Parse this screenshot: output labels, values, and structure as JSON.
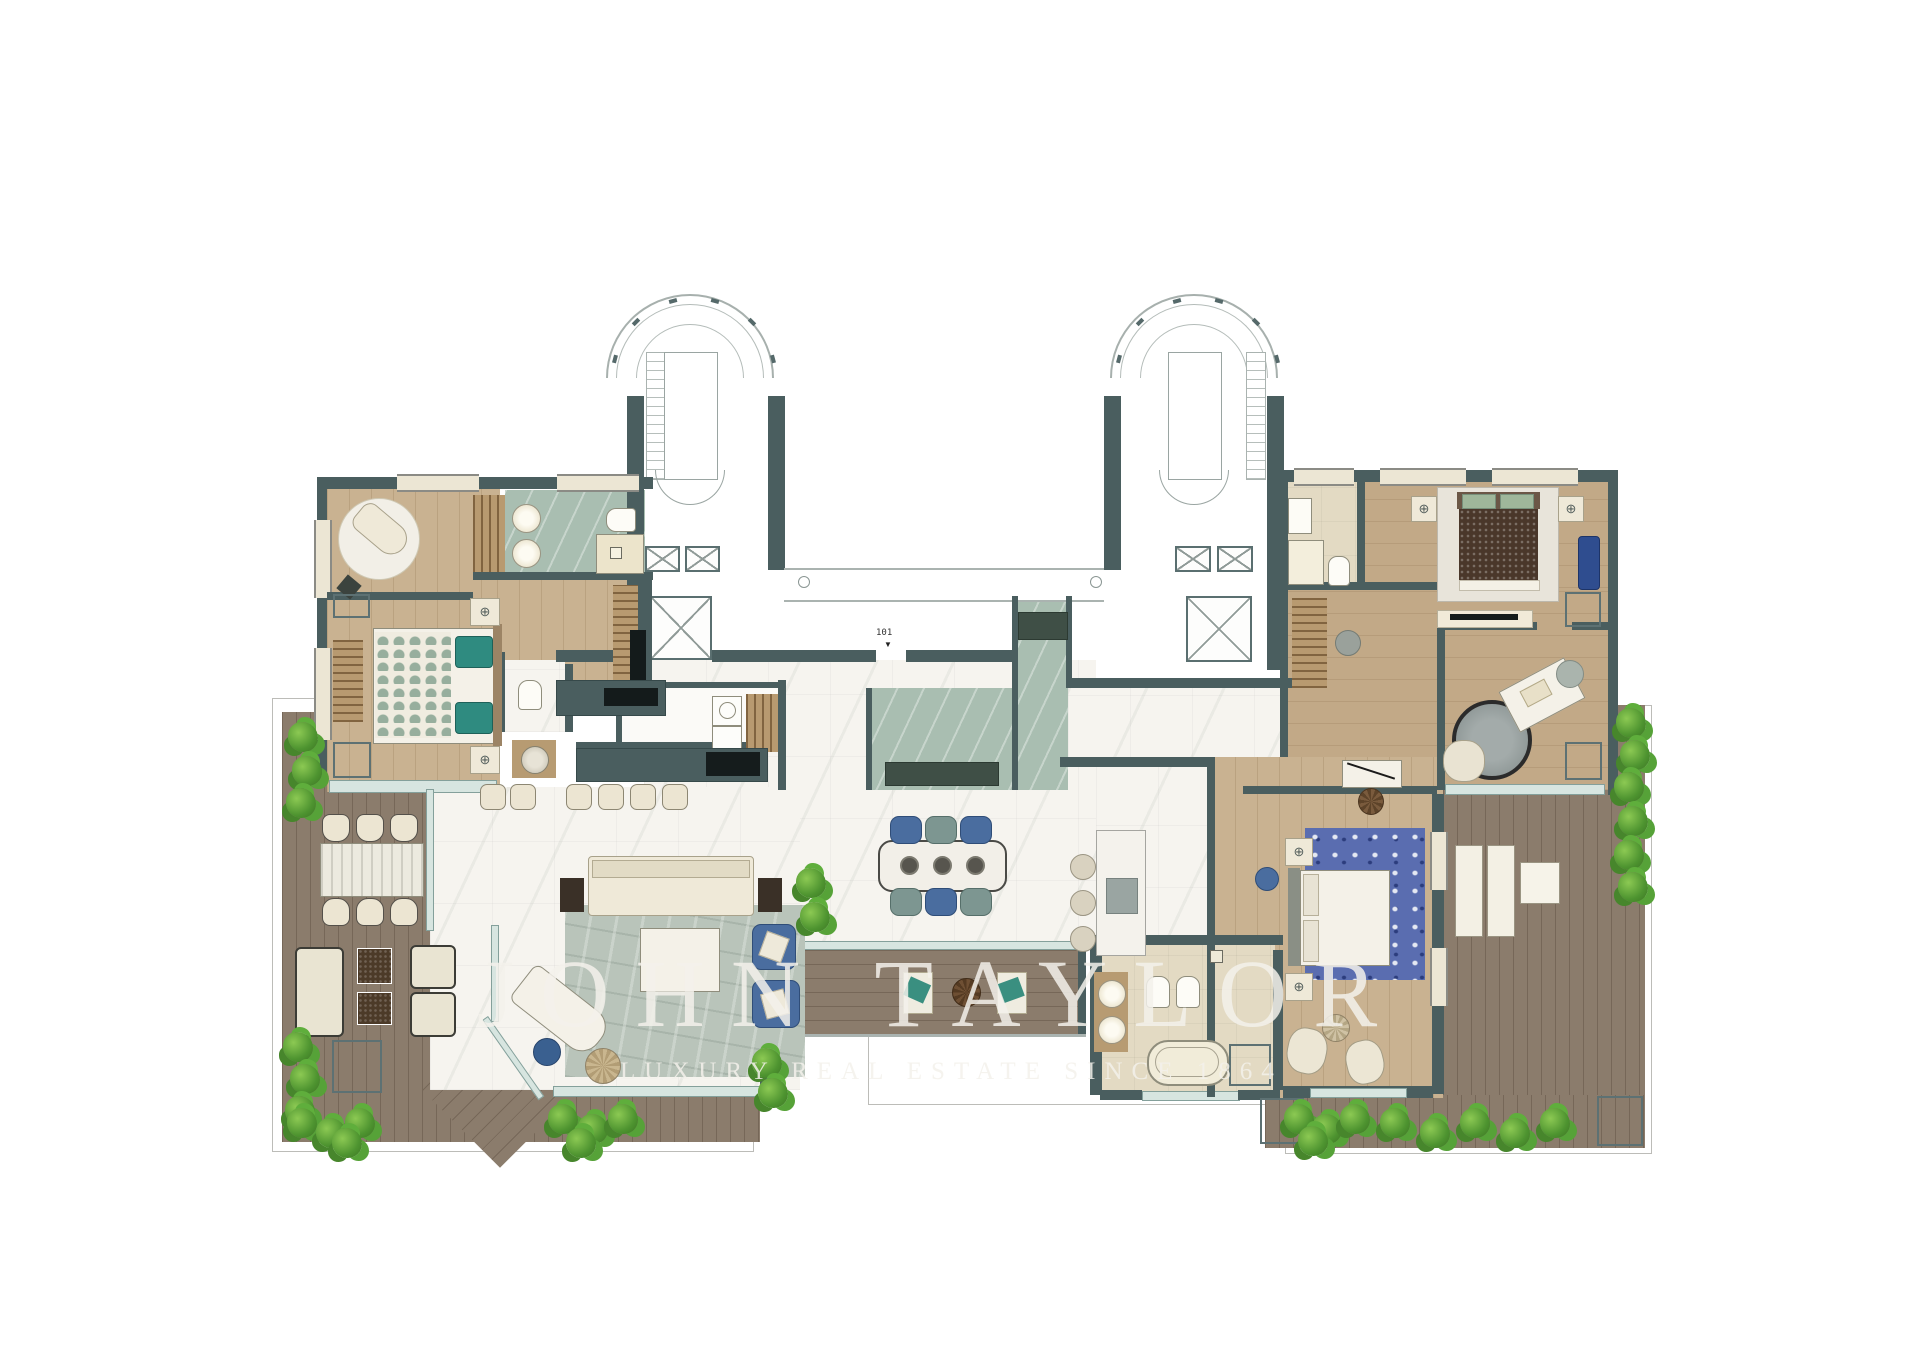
{
  "document": {
    "kind": "floor-plan",
    "background": "#ffffff"
  },
  "watermark": {
    "line1": "JOHN TAYLOR",
    "line2": "LUXURY REAL ESTATE SINCE 1864"
  },
  "plan": {
    "unit_label": "101"
  },
  "icons": {
    "lamp-symbol": "⊕",
    "entry-arrow": "▼"
  },
  "palette": {
    "wall": "#4a5e5f",
    "wood_floor": "#c9b291",
    "deck": "#8b7c6c",
    "white_marble": "#f6f4ef",
    "green_marble": "#a9beb1",
    "stone": "#e3dac3",
    "glass": "#d7e5e0",
    "accent_blue": "#4a6d9f",
    "accent_teal": "#2f8b80",
    "plant_green": "#4e9430",
    "planter": "#415658",
    "bed_brown": "#4a372a"
  }
}
